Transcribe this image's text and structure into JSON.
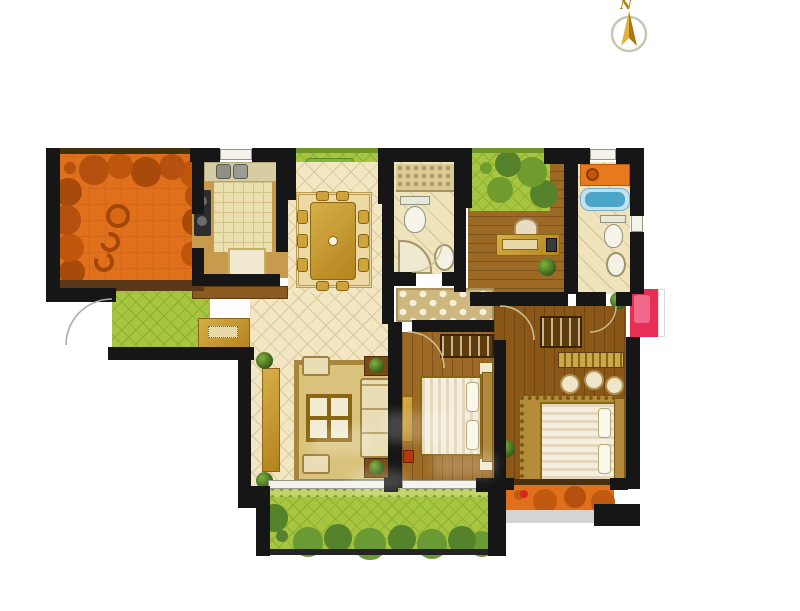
{
  "compass": {
    "label": "N"
  },
  "palette": {
    "wall": "#161616",
    "terrace_orange": "#e0701c",
    "terrace_deco": "#b24e0c",
    "balcony_green": "#a6c642",
    "balcony_green_line": "#8fae2e",
    "bush_green": "#55822a",
    "tile_floor": "#f2e6c3",
    "tile_line": "#d9c89c",
    "wood_light": "#9c6a24",
    "wood_dark": "#8a5717",
    "bath_floor": "#eee3bb",
    "mosaic": "#b49a62",
    "hall_tile": "#cdb77e",
    "hall_diamond": "#f6f0da",
    "counter_orange": "#e8791c",
    "tub_blue": "#4ba6c9",
    "tub_rim": "#c2e2ef",
    "ac_red": "#e92e55",
    "gold_dark": "#8a6512",
    "bedding": "#f4efdd",
    "bedding_stripe": "#e3d8be",
    "headboard": "#b08a3a",
    "rug_master": "#b58d3a",
    "railing_brown": "#5a3818",
    "shadow": "#d4d4d4",
    "plant_dark": "#33591a",
    "compass_gold": "#c9992e",
    "compass_ring": "#c6c6b2"
  },
  "rooms": [
    {
      "name": "terrace"
    },
    {
      "name": "kitchen"
    },
    {
      "name": "north-balcony"
    },
    {
      "name": "dining-room"
    },
    {
      "name": "bathroom"
    },
    {
      "name": "study"
    },
    {
      "name": "master-bathroom"
    },
    {
      "name": "entry"
    },
    {
      "name": "hallway"
    },
    {
      "name": "living-room"
    },
    {
      "name": "bedroom"
    },
    {
      "name": "master-bedroom"
    },
    {
      "name": "south-balcony"
    },
    {
      "name": "rear-balcony"
    }
  ]
}
